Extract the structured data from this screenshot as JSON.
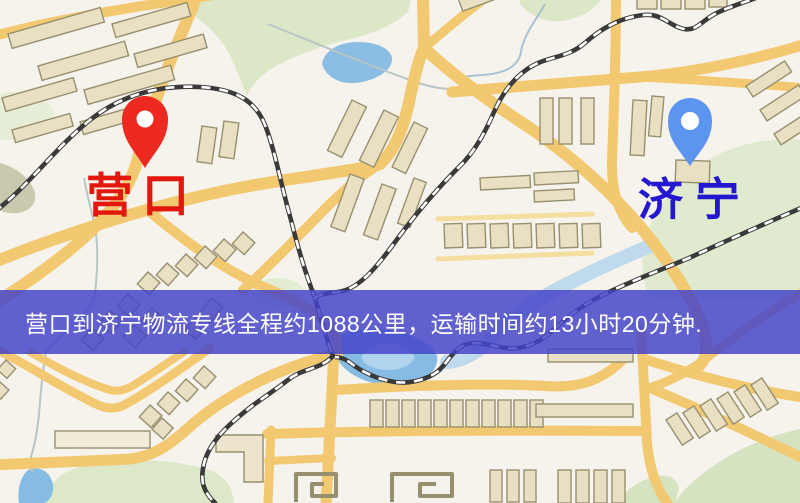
{
  "markers": {
    "yingkou": {
      "label": "营口",
      "label_color": "#e3170d",
      "pin_color": "#ee2920"
    },
    "jining": {
      "label": "济宁",
      "label_color": "#2318cf",
      "pin_color": "#5c95ef"
    }
  },
  "banner": {
    "text": "营口到济宁物流专线全程约1088公里，运输时间约13小时20分钟.",
    "background_color": "rgba(68,68,201,0.84)",
    "text_color": "#ffffff"
  },
  "palette": {
    "map_background": "#f6f2ec",
    "road_major": "#f2c971",
    "road_minor": "#f4dfa0",
    "building_fill": "#e9e0c3",
    "building_stroke": "#97906f",
    "green_area": "#dbe7c6",
    "water": "#86bbe3",
    "river": "#bfdaec",
    "railway_dark": "#3a3a3a",
    "railway_light": "#ffffff"
  }
}
